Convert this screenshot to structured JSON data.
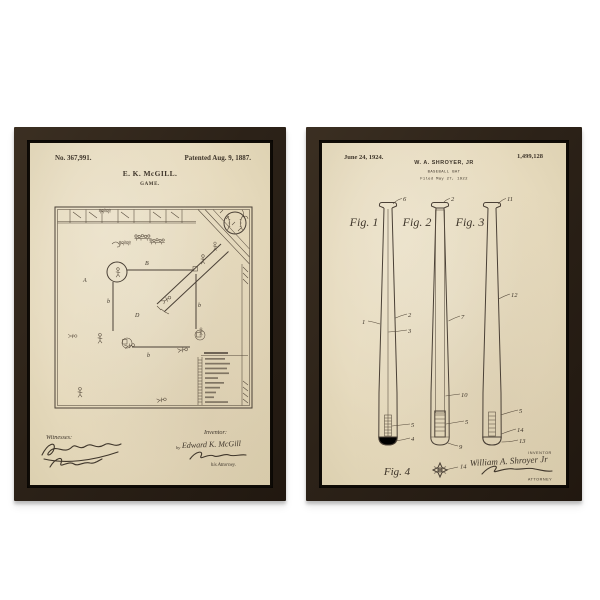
{
  "left_print": {
    "patent_number": "No. 367,991.",
    "patent_date": "Patented Aug. 9, 1887.",
    "inventor_name": "E. K. McGILL.",
    "title": "GAME.",
    "witnesses_label": "Witnesses:",
    "inventor_label": "Inventor:",
    "by_label": "by",
    "inventor_signature": "Edward K. McGill",
    "attorney_note": "his Attorney.",
    "diagram_letters": {
      "a": "A",
      "b_top": "B",
      "b_left": "b",
      "d": "D",
      "b_right": "b",
      "b_bottom": "b"
    }
  },
  "right_print": {
    "issue_date": "June 24, 1924.",
    "patent_number": "1,499,128",
    "inventor_name": "W. A. SHROYER, JR",
    "title": "BASEBALL BAT",
    "filed_line": "Filed May 27, 1922",
    "figure_labels": {
      "fig1": "Fig. 1",
      "fig2": "Fig. 2",
      "fig3": "Fig. 3",
      "fig4": "Fig. 4"
    },
    "callouts": {
      "bat1_knob": "6",
      "bat1_left": "1",
      "bat1_right": "2",
      "bat1_core": "3",
      "bat1_insert": "5",
      "bat1_cap": "4",
      "bat2_knob": "2",
      "bat2_side": "7",
      "bat2_channel": "10",
      "bat2_plug": "5",
      "bat2_cap": "9",
      "bat3_knob": "11",
      "bat3_side": "12",
      "bat3_insert": "5",
      "bat3_mid": "14",
      "bat3_cap": "13",
      "fig4_section": "14"
    },
    "inventor_caption": "INVENTOR",
    "attorney_caption": "ATTORNEY",
    "inventor_signature": "William A. Shroyer Jr"
  },
  "colors": {
    "background": "#ffffff",
    "frame": "#2c2218",
    "paper": "#e6dabd",
    "ink": "#4a4036"
  }
}
